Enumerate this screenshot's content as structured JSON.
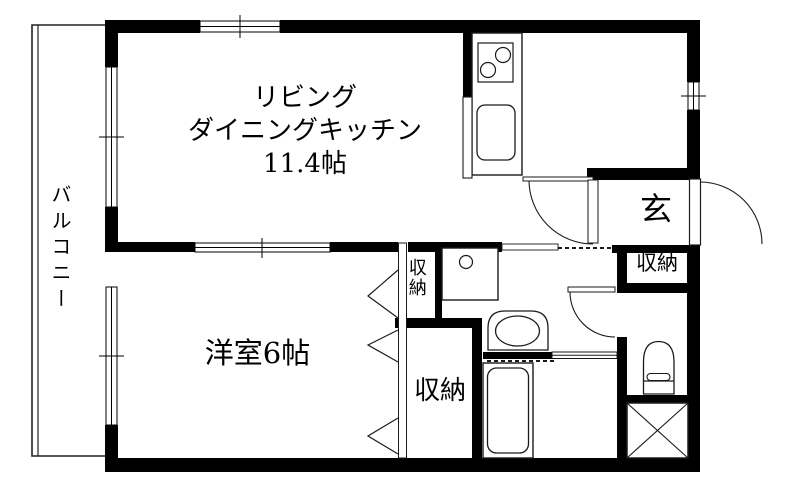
{
  "labels": {
    "ldk_line1": "リビング",
    "ldk_line2": "ダイニングキッチン",
    "ldk_line3": "11.4帖",
    "bedroom": "洋室6帖",
    "balcony": "バルコニー",
    "entrance": "玄",
    "entrance_closet": "収納",
    "hall_closet": "収納",
    "bedroom_closet": "収納"
  },
  "colors": {
    "wall": "#000000",
    "background": "#ffffff",
    "fixture_line": "#1a1a1a"
  }
}
